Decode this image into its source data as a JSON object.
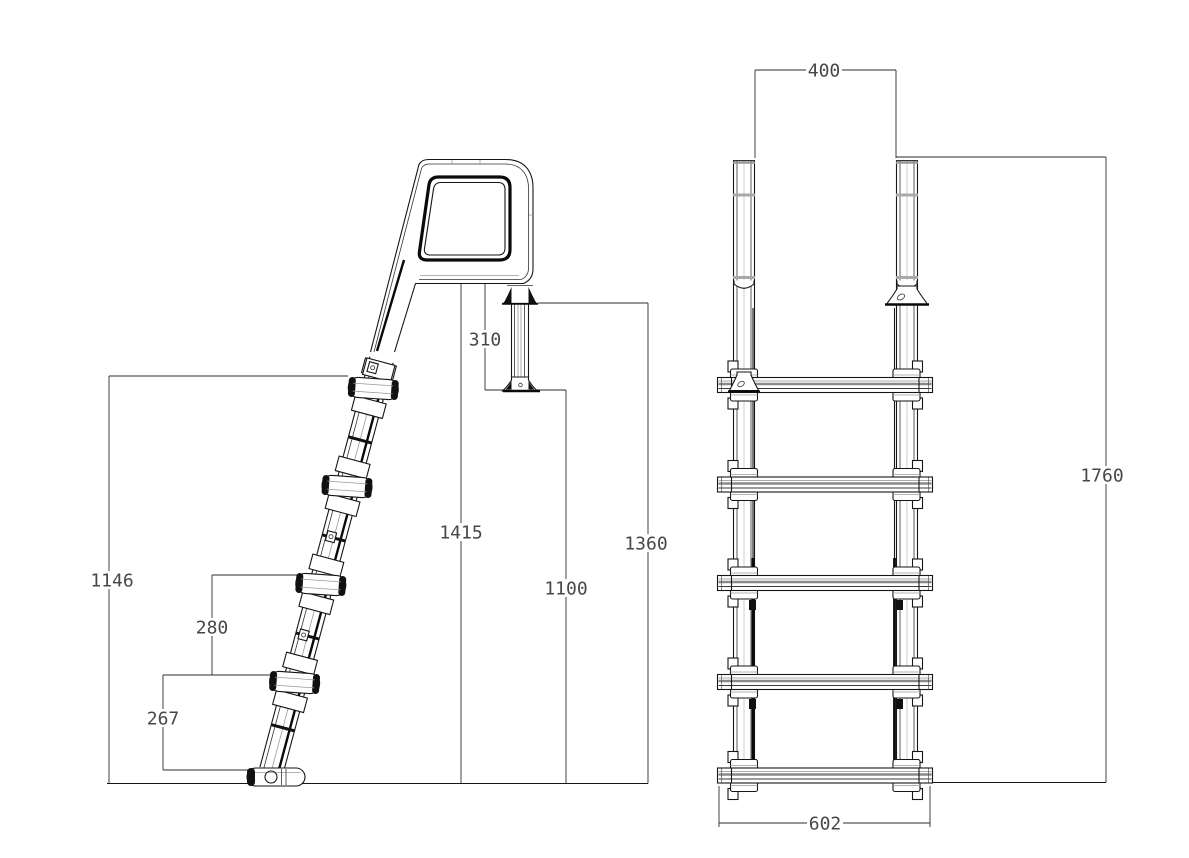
{
  "dimensions": {
    "d400": "400",
    "d1760": "1760",
    "d602": "602",
    "d310": "310",
    "d1415": "1415",
    "d1100": "1100",
    "d1360": "1360",
    "d1146": "1146",
    "d280": "280",
    "d267": "267"
  },
  "colors": {
    "background": "#ffffff",
    "line": "#161616",
    "dim_text": "#474747"
  }
}
